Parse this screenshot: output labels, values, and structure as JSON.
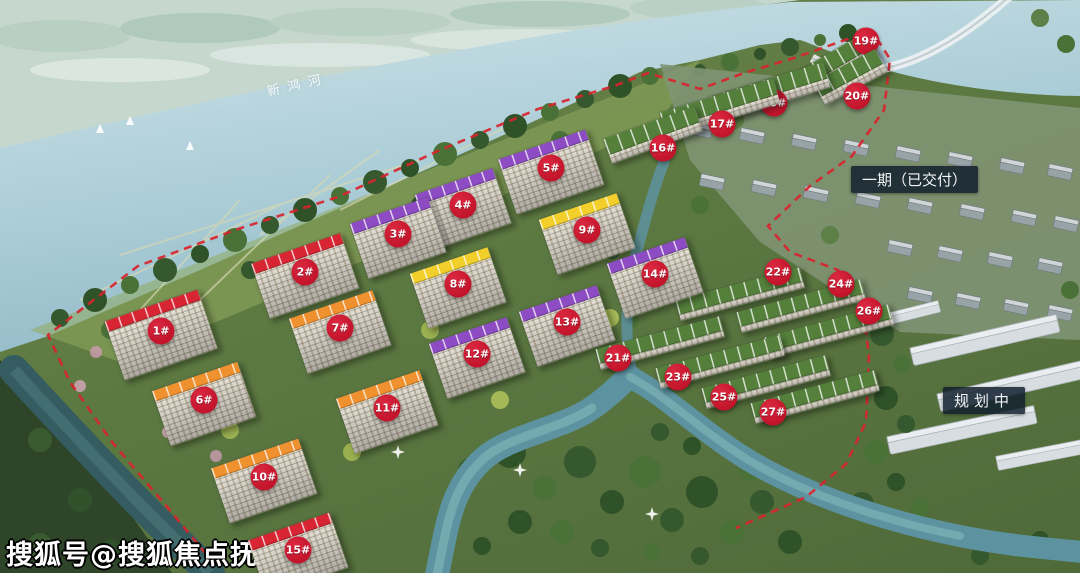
{
  "watermark": {
    "text": "搜狐号@搜狐焦点抚州站"
  },
  "labels": {
    "river": "新鸿河",
    "phase1": "一期（已交付）",
    "planning": "规划中"
  },
  "colors": {
    "badge": "#c01228",
    "badge_text": "#ffffff",
    "boundary": "#d8242e",
    "roof_red": "#d82533",
    "roof_orange": "#f0912f",
    "roof_yellow": "#f2cf2b",
    "roof_purple": "#8d4cc4",
    "roof_green": "#55803c"
  },
  "markers": [
    {
      "label": "1#",
      "x": 161,
      "y": 331,
      "kind": "tower",
      "roof": "red",
      "w": 98,
      "h": 62
    },
    {
      "label": "2#",
      "x": 305,
      "y": 272,
      "kind": "tower",
      "roof": "red",
      "w": 94
    },
    {
      "label": "3#",
      "x": 398,
      "y": 234,
      "kind": "tower",
      "roof": "purple"
    },
    {
      "label": "4#",
      "x": 463,
      "y": 205,
      "kind": "tower",
      "roof": "purple"
    },
    {
      "label": "5#",
      "x": 551,
      "y": 168,
      "kind": "tower",
      "roof": "purple",
      "w": 92
    },
    {
      "label": "6#",
      "x": 204,
      "y": 400,
      "kind": "tower",
      "roof": "orange",
      "w": 90
    },
    {
      "label": "7#",
      "x": 340,
      "y": 328,
      "kind": "tower",
      "roof": "orange",
      "w": 88
    },
    {
      "label": "8#",
      "x": 458,
      "y": 284,
      "kind": "tower",
      "roof": "yellow"
    },
    {
      "label": "9#",
      "x": 587,
      "y": 230,
      "kind": "tower",
      "roof": "yellow"
    },
    {
      "label": "10#",
      "x": 264,
      "y": 477,
      "kind": "tower",
      "roof": "orange",
      "w": 92
    },
    {
      "label": "11#",
      "x": 387,
      "y": 408,
      "kind": "tower",
      "roof": "orange",
      "w": 88
    },
    {
      "label": "12#",
      "x": 477,
      "y": 354,
      "kind": "tower",
      "roof": "purple"
    },
    {
      "label": "13#",
      "x": 567,
      "y": 322,
      "kind": "tower",
      "roof": "purple"
    },
    {
      "label": "14#",
      "x": 655,
      "y": 274,
      "kind": "tower",
      "roof": "purple"
    },
    {
      "label": "15#",
      "x": 298,
      "y": 550,
      "kind": "tower",
      "roof": "red",
      "w": 86
    },
    {
      "label": "16#",
      "x": 663,
      "y": 148,
      "kind": "slab",
      "roof": "green",
      "w": 96,
      "dx": -10,
      "dy": -13,
      "rot": -20
    },
    {
      "label": "17#",
      "x": 722,
      "y": 124,
      "kind": "slab",
      "roof": "green",
      "dx": -2,
      "dy": -16,
      "rot": -17
    },
    {
      "label": "18#",
      "x": 774,
      "y": 103,
      "kind": "slab",
      "roof": "green",
      "dx": -4,
      "dy": -11,
      "rot": -17
    },
    {
      "label": "19#",
      "x": 866,
      "y": 41,
      "kind": "slab",
      "roof": "green",
      "w": 74,
      "dx": -28,
      "dy": 22,
      "rot": -30
    },
    {
      "label": "20#",
      "x": 857,
      "y": 96,
      "kind": "slab",
      "roof": "green",
      "w": 70,
      "dx": -7,
      "dy": -19,
      "rot": -28
    },
    {
      "label": "21#",
      "x": 618,
      "y": 358,
      "kind": "row",
      "roof": "green"
    },
    {
      "label": "22#",
      "x": 778,
      "y": 272,
      "kind": "row",
      "roof": "green",
      "dx": -38,
      "dy": 22
    },
    {
      "label": "23#",
      "x": 678,
      "y": 377,
      "kind": "row",
      "roof": "green"
    },
    {
      "label": "24#",
      "x": 841,
      "y": 284,
      "kind": "row",
      "roof": "green",
      "dx": -40,
      "dy": 22
    },
    {
      "label": "25#",
      "x": 724,
      "y": 397,
      "kind": "row",
      "roof": "green"
    },
    {
      "label": "26#",
      "x": 869,
      "y": 311,
      "kind": "row",
      "roof": "green",
      "dx": -40,
      "dy": 20
    },
    {
      "label": "27#",
      "x": 773,
      "y": 412,
      "kind": "row",
      "roof": "green"
    }
  ]
}
